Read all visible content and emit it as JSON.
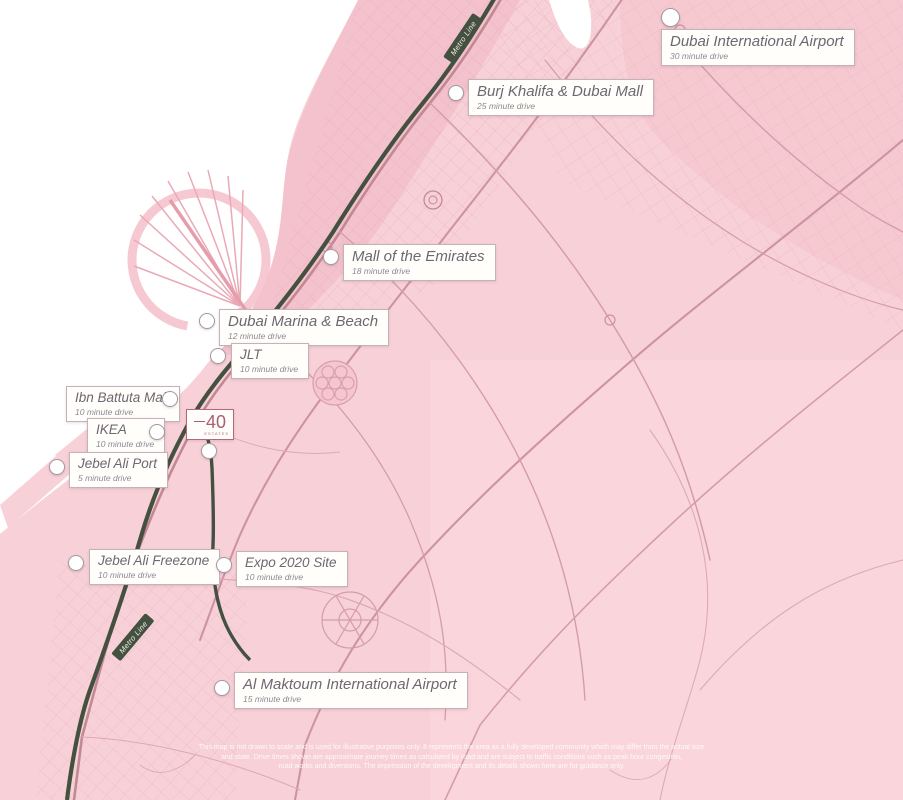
{
  "map": {
    "land_color": "#f8d1d8",
    "sea_color": "#ffffff",
    "metro_color": "#455140",
    "road_color": "#cc93a0",
    "accent_color": "#b06273"
  },
  "metro_labels": {
    "top": "Metro Line",
    "bottom": "Metro Line"
  },
  "logo": {
    "number": "40",
    "subtext": "ESTATES"
  },
  "locations": [
    {
      "name": "Dubai International Airport",
      "drive": "30 minute drive"
    },
    {
      "name": "Burj Khalifa & Dubai Mall",
      "drive": "25 minute drive"
    },
    {
      "name": "Mall of the Emirates",
      "drive": "18 minute drive"
    },
    {
      "name": "Dubai Marina & Beach",
      "drive": "12 minute drive"
    },
    {
      "name": "JLT",
      "drive": "10 minute drive"
    },
    {
      "name": "Ibn Battuta Mall",
      "drive": "10 minute drive"
    },
    {
      "name": "IKEA",
      "drive": "10 minute drive"
    },
    {
      "name": "Jebel Ali Port",
      "drive": "5 minute drive"
    },
    {
      "name": "Jebel Ali Freezone",
      "drive": "10 minute drive"
    },
    {
      "name": "Expo 2020 Site",
      "drive": "10 minute drive"
    },
    {
      "name": "Al Maktoum International Airport",
      "drive": "15 minute drive"
    }
  ],
  "disclaimer": {
    "line1": "This map is not drawn to scale and is used for illustrative purposes only. It represents the area as a fully developed community which may differ from the actual size",
    "line2": "and state. Drive times shown are approximate journey times as calculated by road and are subject to traffic conditions such as peak hour congestion,",
    "line3": "road works and diversions. The impression of the development and its details shown here are for guidance only."
  }
}
